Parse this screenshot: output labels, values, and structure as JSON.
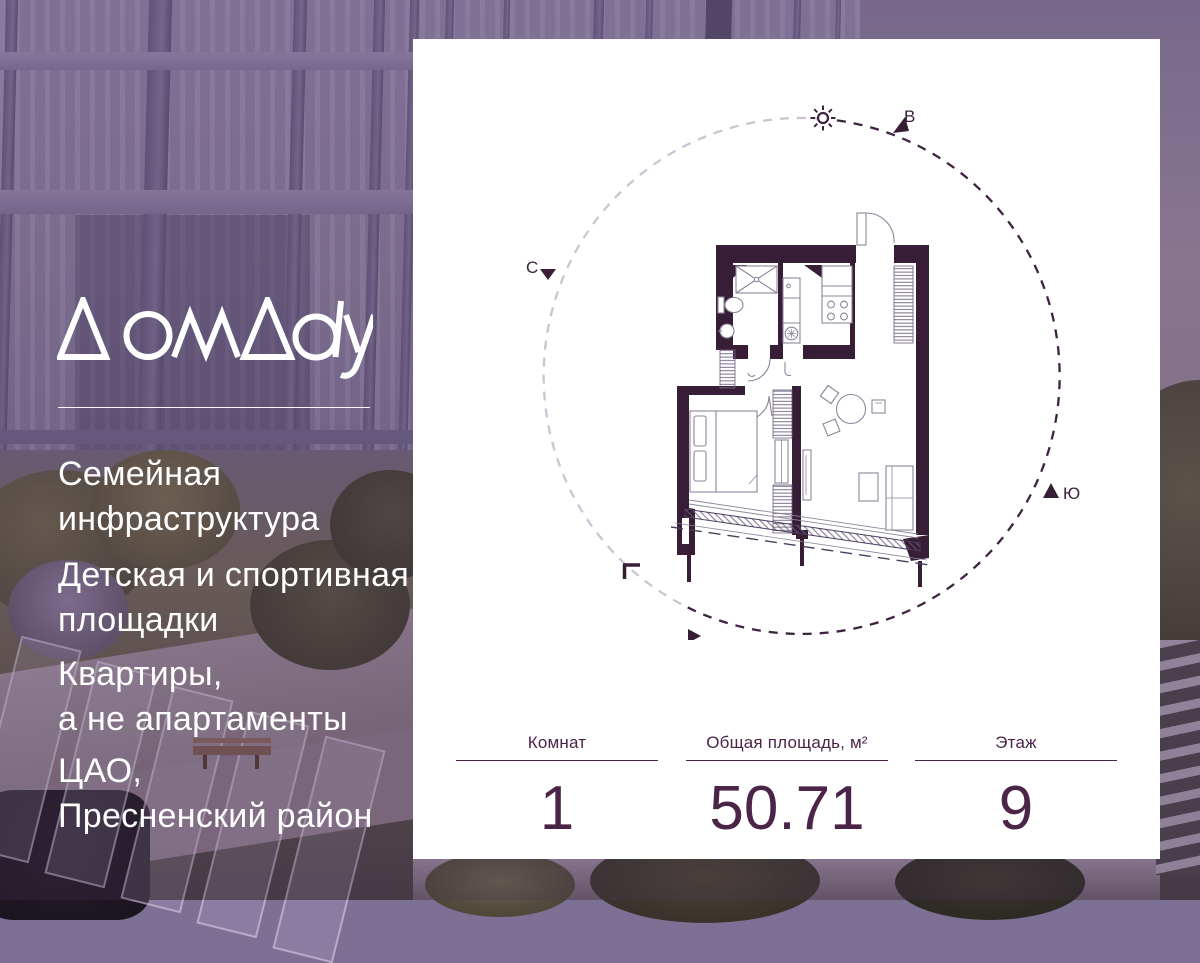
{
  "brand": {
    "logo_text": "ДомДау"
  },
  "left_panel": {
    "features": [
      {
        "line1": "Семейная",
        "line2": "инфраструктура"
      },
      {
        "line1": "Детская и спортивная",
        "line2": "площадки"
      },
      {
        "line1": "Квартиры,",
        "line2": "а не апартаменты"
      },
      {
        "line1": "ЦАО,",
        "line2": "Пресненский район"
      }
    ]
  },
  "card": {
    "compass": {
      "north": "С",
      "east": "В",
      "south": "Ю",
      "west": "З"
    },
    "stats": [
      {
        "label": "Комнат",
        "value": "1"
      },
      {
        "label": "Общая площадь, м²",
        "value": "50.71"
      },
      {
        "label": "Этаж",
        "value": "9"
      }
    ]
  },
  "colors": {
    "brand_dark_purple": "#4b2448",
    "plan_wall": "#371d36",
    "card_background": "#ffffff",
    "photo_overlay": "#6a4a82",
    "compass_light_arc": "#cbc5d3"
  }
}
